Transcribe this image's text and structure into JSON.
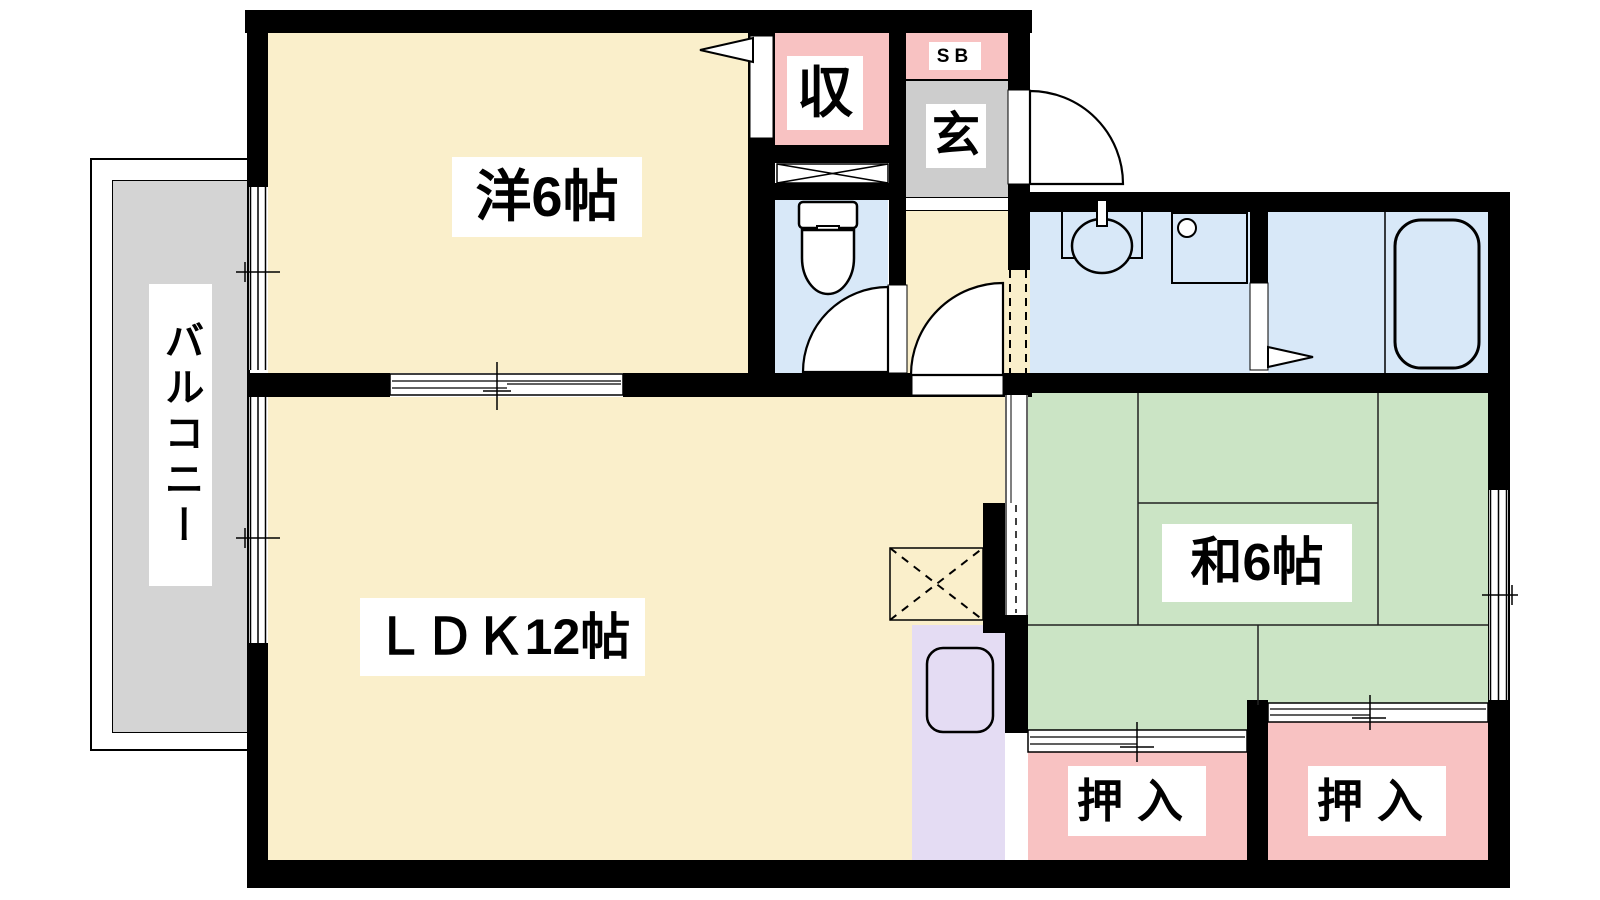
{
  "plan": {
    "type": "floor-plan",
    "rooms": {
      "western": {
        "label": "洋6帖"
      },
      "ldk": {
        "label": "ＬＤＫ12帖"
      },
      "japanese": {
        "label": "和6帖"
      },
      "balcony": {
        "label": "バルコニー"
      },
      "genkan": {
        "label": "玄"
      },
      "shoe_box": {
        "label": "SB"
      },
      "closet": {
        "label": "収"
      },
      "oshiire_left": {
        "label": "押入"
      },
      "oshiire_right": {
        "label": "押入"
      }
    },
    "colors": {
      "wall": "#000000",
      "room_cream": "#FAEFCB",
      "tatami_green": "#CBE4C5",
      "wet_area_blue": "#D8E8F8",
      "closet_pink": "#F8C2C2",
      "genkan_gray": "#CDCDCD",
      "balcony_gray": "#D4D4D4",
      "kitchen_purple": "#E4DCF3",
      "label_background": "#FFFFFF"
    }
  }
}
